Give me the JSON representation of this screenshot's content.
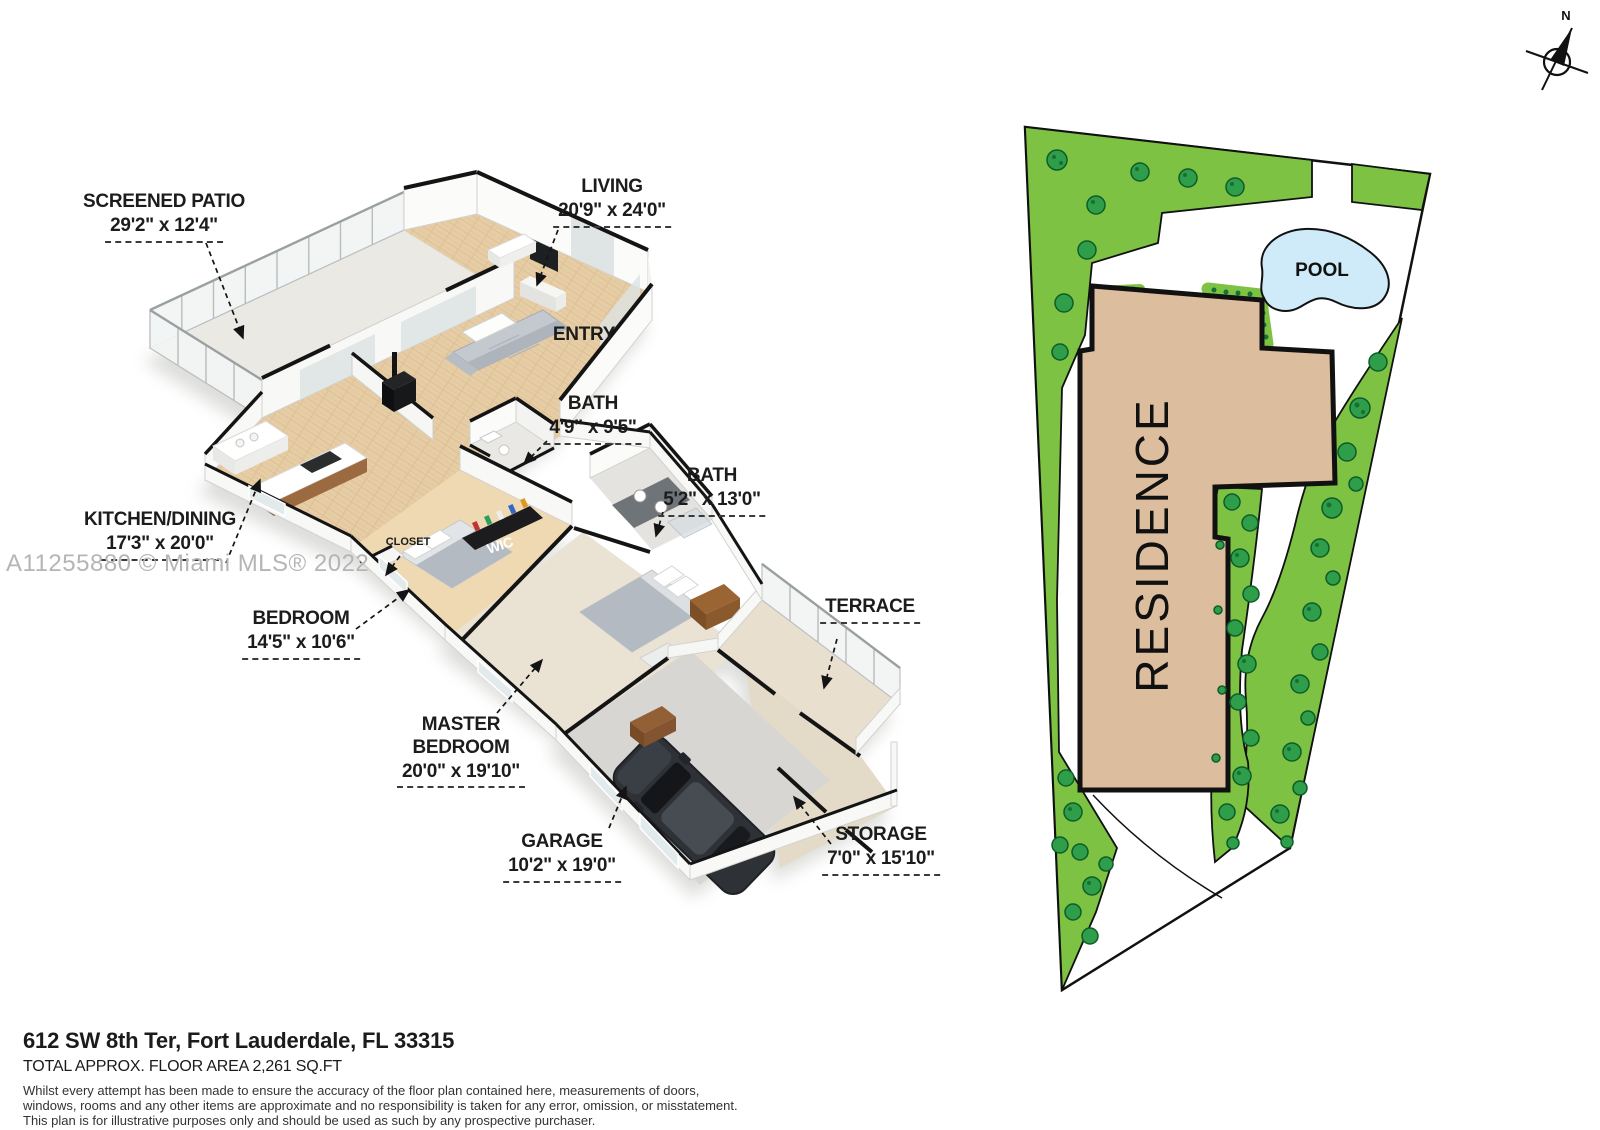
{
  "watermark": {
    "text": "A11255880 © Miami MLS® 2022"
  },
  "compass": {
    "north": "N"
  },
  "floor_plan": {
    "labels": [
      {
        "id": "screened-patio",
        "name": "SCREENED PATIO",
        "dims": "29'2\" x 12'4\""
      },
      {
        "id": "living",
        "name": "LIVING",
        "dims": "20'9\" x 24'0\""
      },
      {
        "id": "entry",
        "name": "ENTRY",
        "dims": ""
      },
      {
        "id": "bath-1",
        "name": "BATH",
        "dims": "4'9\" x 9'5\""
      },
      {
        "id": "bath-2",
        "name": "BATH",
        "dims": "5'2\" x 13'0\""
      },
      {
        "id": "kitchen-dining",
        "name": "KITCHEN/DINING",
        "dims": "17'3\" x 20'0\""
      },
      {
        "id": "bedroom",
        "name": "BEDROOM",
        "dims": "14'5\" x 10'6\""
      },
      {
        "id": "terrace",
        "name": "TERRACE",
        "dims": ""
      },
      {
        "id": "master-bedroom",
        "name": "MASTER BEDROOM",
        "dims": "20'0\" x 19'10\""
      },
      {
        "id": "garage",
        "name": "GARAGE",
        "dims": "10'2\" x 19'0\""
      },
      {
        "id": "storage",
        "name": "STORAGE",
        "dims": "7'0\" x 15'10\""
      },
      {
        "id": "closet",
        "name": "CLOSET",
        "dims": ""
      },
      {
        "id": "wic",
        "name": "WIC",
        "dims": ""
      }
    ]
  },
  "site_plan": {
    "residence": "RESIDENCE",
    "pool": "POOL"
  },
  "footer": {
    "address": "612 SW 8th Ter, Fort Lauderdale, FL 33315",
    "area": "TOTAL APPROX. FLOOR AREA 2,261 SQ.FT",
    "disclaimer_lines": [
      "Whilst every attempt has been made to ensure the accuracy of the floor plan contained here, measurements of doors,",
      "windows, rooms and any other items are approximate and no responsibility is taken for any error, omission, or misstatement.",
      "This plan is for illustrative purposes only and should be used as such by any prospective purchaser."
    ]
  },
  "colors": {
    "lawn": "#7dc242",
    "tree": "#2f9e4a",
    "pool": "#cfeaf8",
    "residence_fill": "#dcbd9e",
    "wood_floor": "#e7cda5",
    "cap_black": "#141414"
  }
}
